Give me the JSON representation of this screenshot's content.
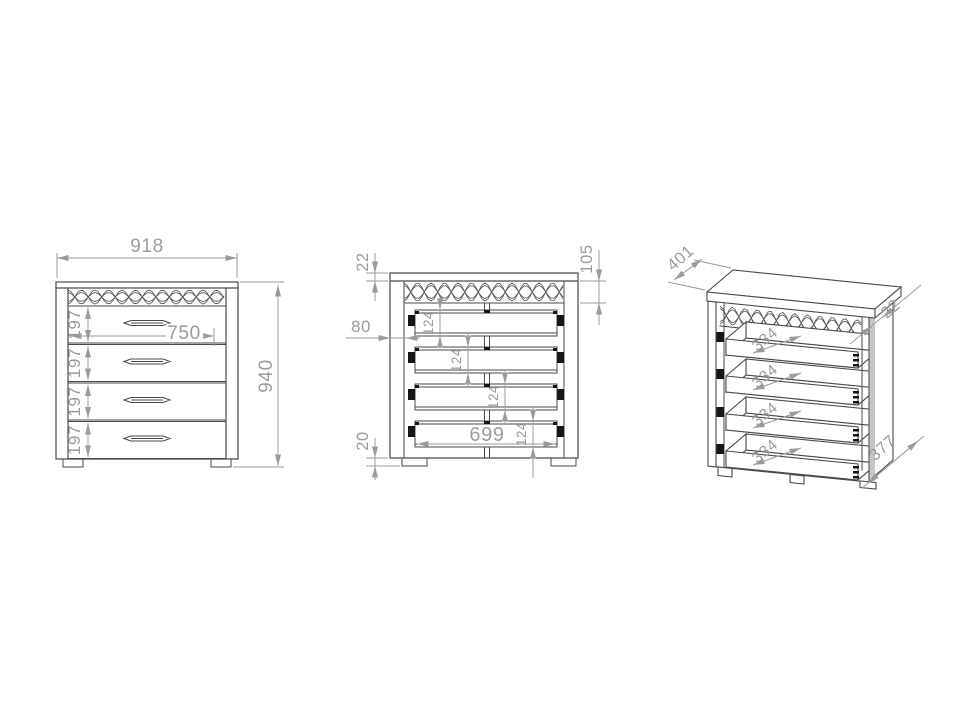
{
  "document": {
    "type": "furniture-dimension-drawing",
    "background": "#ffffff",
    "outline_color": "#4a4a4a",
    "dimension_color": "#9b9b9b",
    "hardware_color": "#161616"
  },
  "views": {
    "front": {
      "label": "front-elevation",
      "width": "918",
      "height": "940",
      "handle_span": "750",
      "drawer_heights": [
        "197",
        "197",
        "197",
        "197"
      ]
    },
    "carcass": {
      "label": "internal-elevation",
      "top_thickness": "22",
      "top_rail_height": "105",
      "runner_offset": "80",
      "box_heights": [
        "124",
        "124",
        "124",
        "124"
      ],
      "plinth_height": "20",
      "inner_width": "699"
    },
    "side": {
      "label": "isometric-view",
      "top_depth": "401",
      "top_thickness": "22",
      "box_depths": [
        "334",
        "334",
        "334",
        "334"
      ],
      "panel_depth": "377"
    }
  }
}
